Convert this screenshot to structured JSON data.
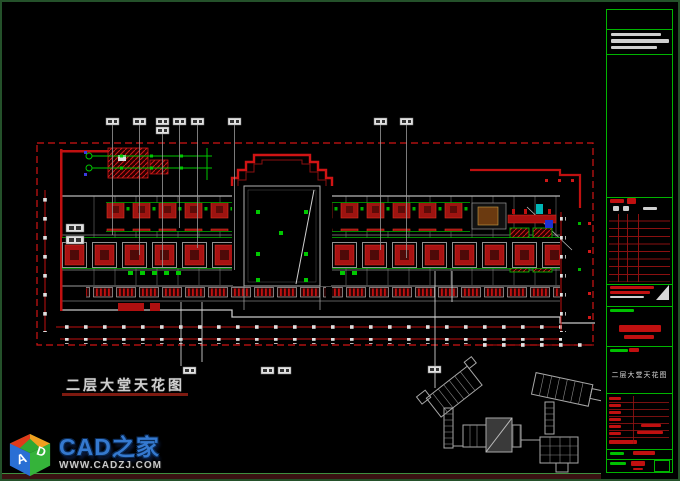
{
  "drawing": {
    "title": "二层大堂天花图"
  },
  "title_block": {
    "drawing_name": "二层大堂天花图"
  },
  "watermark": {
    "brand": "CAD之家",
    "site": "WWW.CADZJ.COM",
    "logo": {
      "letter_a": "A",
      "letter_d": "D"
    }
  },
  "colors": {
    "background": "#000000",
    "cad_red": "#c01010",
    "cad_green": "#00c000",
    "cad_grey": "#b5b5b5",
    "frame_green": "#00b400",
    "outer_border_green": "#24512a",
    "brand_blue": "#3579cf",
    "strip_maroon": "#3a1212"
  }
}
